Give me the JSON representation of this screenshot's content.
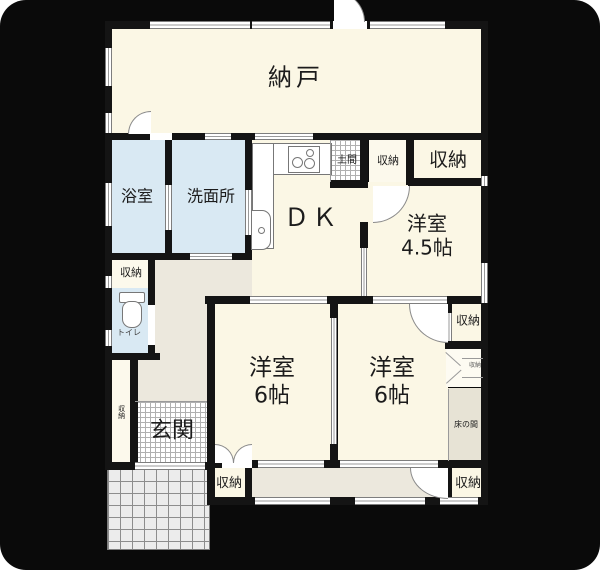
{
  "palette": {
    "wall": "#141414",
    "room_cream": "#FBF7E5",
    "water_blue": "#D9E9F3",
    "hall_gray": "#ECE8DD",
    "tokonoma_beige": "#E7E3D5",
    "porch_gray": "#ECECEC",
    "background": "#0a0a0a"
  },
  "rooms": {
    "nando": {
      "label": "納戸"
    },
    "bathroom": {
      "label": "浴室"
    },
    "washroom": {
      "label": "洗面所"
    },
    "dk": {
      "label": "ＤＫ"
    },
    "doma": {
      "label": "土間"
    },
    "toilet": {
      "label": "トイレ"
    },
    "genkan": {
      "label": "玄関"
    },
    "yoshitsu45": {
      "label": "洋室",
      "size": "4.5帖"
    },
    "yoshitsu6_left": {
      "label": "洋室",
      "size": "6帖"
    },
    "yoshitsu6_right": {
      "label": "洋室",
      "size": "6帖"
    },
    "tokonoma": {
      "label": "床の間"
    }
  },
  "closets": {
    "top_small": "収納",
    "top_large": "収納",
    "above_toilet": "収納",
    "left_tall": "収納",
    "right_top": "収納",
    "right_mid": "収納",
    "right_bottom": "収納",
    "bottom_left": "収納"
  }
}
